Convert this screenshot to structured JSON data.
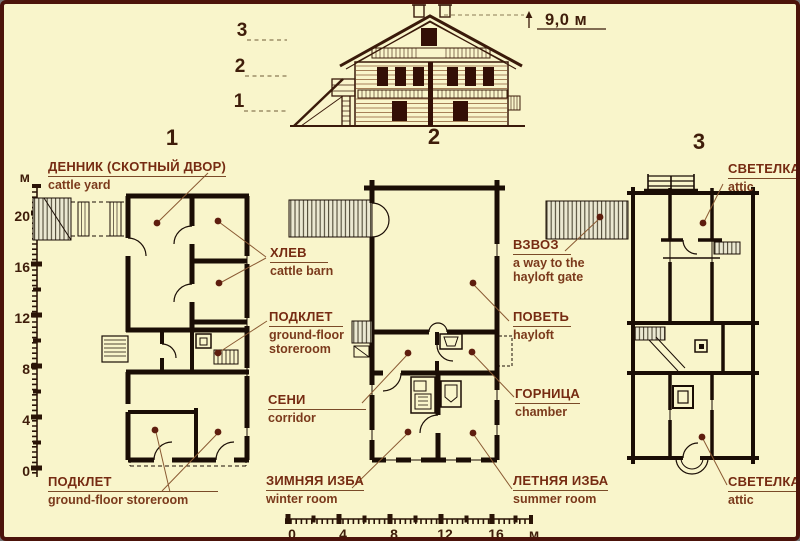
{
  "palette": {
    "background": "#f9f5cb",
    "frame": "#4c130a",
    "ink": "#1a0d05",
    "label": "#762b12",
    "dot": "#5e1d0e"
  },
  "elevation": {
    "height_label": "9,0 м",
    "floor_markers": [
      "3",
      "2",
      "1"
    ]
  },
  "plan_numbers": [
    "1",
    "2",
    "3"
  ],
  "labels": {
    "cattle_yard": {
      "ru": "ДЕННИК (СКОТНЫЙ ДВОР)",
      "en": "cattle yard"
    },
    "cattle_barn": {
      "ru": "ХЛЕВ",
      "en": "cattle barn"
    },
    "storeroom_mid": {
      "ru": "ПОДКЛЕТ",
      "en": "ground-floor\nstoreroom"
    },
    "storeroom_bottom": {
      "ru": "ПОДКЛЕТ",
      "en": "ground-floor storeroom"
    },
    "hayloft_ramp": {
      "ru": "ВЗВОЗ",
      "en": "a way to the\nhayloft gate"
    },
    "hayloft": {
      "ru": "ПОВЕТЬ",
      "en": "hayloft"
    },
    "corridor": {
      "ru": "СЕНИ",
      "en": "corridor"
    },
    "chamber": {
      "ru": "ГОРНИЦА",
      "en": "chamber"
    },
    "winter_room": {
      "ru": "ЗИМНЯЯ ИЗБА",
      "en": "winter room"
    },
    "summer_room": {
      "ru": "ЛЕТНЯЯ ИЗБА",
      "en": "summer room"
    },
    "attic_top": {
      "ru": "СВЕТЕЛКА",
      "en": "attic"
    },
    "attic_bottom": {
      "ru": "СВЕТЕЛКА",
      "en": "attic"
    }
  },
  "vertical_scale": {
    "unit": "м",
    "ticks": [
      "20",
      "16",
      "12",
      "8",
      "4",
      "0"
    ]
  },
  "horizontal_scale": {
    "ticks": [
      "0",
      "4",
      "8",
      "12",
      "16"
    ],
    "unit": "м"
  }
}
